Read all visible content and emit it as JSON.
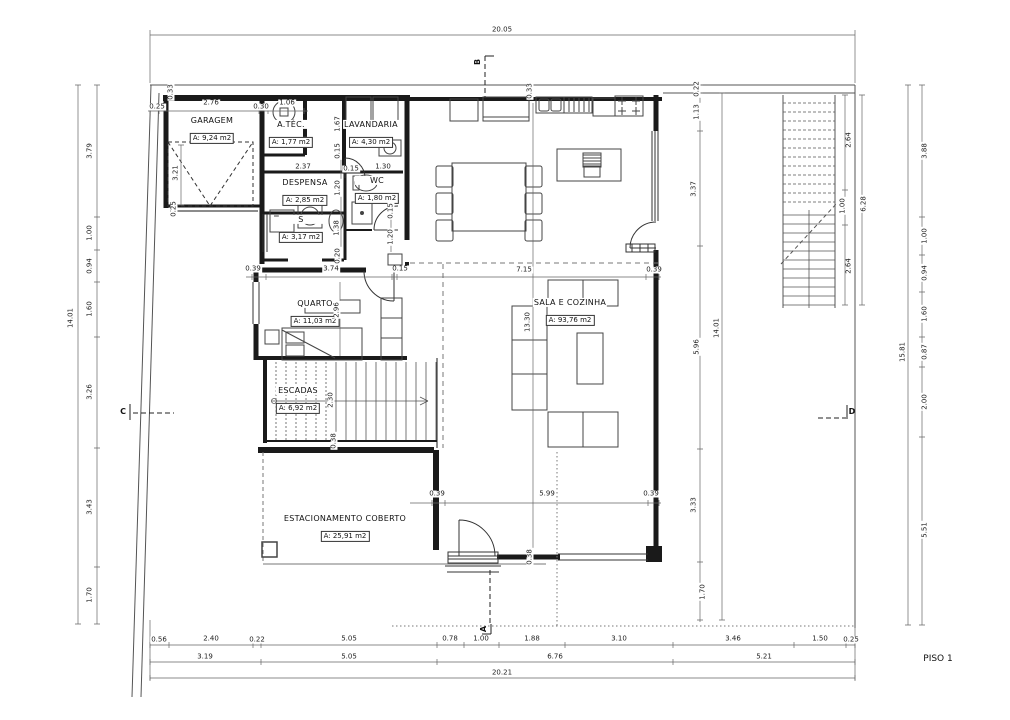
{
  "title": {
    "floor": "PISO 1"
  },
  "rooms": [
    {
      "name": "GARAGEM",
      "area": "A: 9,24 m2",
      "x": 212,
      "y": 130
    },
    {
      "name": "A.TÉC.",
      "area": "A: 1,77 m2",
      "x": 291,
      "y": 134
    },
    {
      "name": "LAVANDARIA",
      "area": "A: 4,30 m2",
      "x": 371,
      "y": 134
    },
    {
      "name": "DESPENSA",
      "area": "A: 2,85 m2",
      "x": 305,
      "y": 192
    },
    {
      "name": "WC",
      "area": "A: 1,80 m2",
      "x": 377,
      "y": 190
    },
    {
      "name": "S",
      "area": "A: 3,17 m2",
      "x": 301,
      "y": 229
    },
    {
      "name": "QUARTO",
      "area": "A: 11,03 m2",
      "x": 315,
      "y": 313
    },
    {
      "name": "ESCADAS",
      "area": "A: 6,92 m2",
      "x": 298,
      "y": 400
    },
    {
      "name": "SALA E COZINHA",
      "area": "A: 93,76 m2",
      "x": 570,
      "y": 312
    },
    {
      "name": "ESTACIONAMENTO COBERTO",
      "area": "A: 25,91 m2",
      "x": 345,
      "y": 528
    }
  ],
  "dimensions": [
    {
      "v": "20.05",
      "x": 502,
      "y": 30,
      "o": "h"
    },
    {
      "v": "0.25",
      "x": 157,
      "y": 107,
      "o": "h"
    },
    {
      "v": "2.76",
      "x": 211,
      "y": 103,
      "o": "h"
    },
    {
      "v": "0.30",
      "x": 261,
      "y": 107,
      "o": "h"
    },
    {
      "v": "1.06",
      "x": 287,
      "y": 103,
      "o": "h"
    },
    {
      "v": "0.33",
      "x": 171,
      "y": 92,
      "o": "v"
    },
    {
      "v": "0.33",
      "x": 530,
      "y": 91,
      "o": "v"
    },
    {
      "v": "3.21",
      "x": 176,
      "y": 173,
      "o": "v"
    },
    {
      "v": "0.25",
      "x": 174,
      "y": 209,
      "o": "v"
    },
    {
      "v": "14.01",
      "x": 71,
      "y": 318,
      "o": "v"
    },
    {
      "v": "3.79",
      "x": 90,
      "y": 151,
      "o": "v"
    },
    {
      "v": "1.00",
      "x": 90,
      "y": 233,
      "o": "v"
    },
    {
      "v": "0.94",
      "x": 90,
      "y": 266,
      "o": "v"
    },
    {
      "v": "1.60",
      "x": 90,
      "y": 309,
      "o": "v"
    },
    {
      "v": "3.26",
      "x": 90,
      "y": 392,
      "o": "v"
    },
    {
      "v": "3.43",
      "x": 90,
      "y": 507,
      "o": "v"
    },
    {
      "v": "1.70",
      "x": 90,
      "y": 595,
      "o": "v"
    },
    {
      "v": "1.67",
      "x": 338,
      "y": 124,
      "o": "v"
    },
    {
      "v": "2.37",
      "x": 303,
      "y": 167,
      "o": "h"
    },
    {
      "v": "0.15",
      "x": 351,
      "y": 169,
      "o": "h"
    },
    {
      "v": "1.30",
      "x": 383,
      "y": 167,
      "o": "h"
    },
    {
      "v": "0.15",
      "x": 338,
      "y": 151,
      "o": "v"
    },
    {
      "v": "1.20",
      "x": 338,
      "y": 188,
      "o": "v"
    },
    {
      "v": "1.38",
      "x": 337,
      "y": 228,
      "o": "v"
    },
    {
      "v": "0.20",
      "x": 338,
      "y": 256,
      "o": "v"
    },
    {
      "v": "0.15",
      "x": 391,
      "y": 211,
      "o": "v"
    },
    {
      "v": "1.20",
      "x": 391,
      "y": 237,
      "o": "v"
    },
    {
      "v": "0.39",
      "x": 253,
      "y": 269,
      "o": "h"
    },
    {
      "v": "3.74",
      "x": 331,
      "y": 269,
      "o": "h"
    },
    {
      "v": "0.15",
      "x": 400,
      "y": 269,
      "o": "h"
    },
    {
      "v": "7.15",
      "x": 524,
      "y": 270,
      "o": "h"
    },
    {
      "v": "0.39",
      "x": 654,
      "y": 270,
      "o": "h"
    },
    {
      "v": "2.96",
      "x": 337,
      "y": 310,
      "o": "v"
    },
    {
      "v": "13.30",
      "x": 528,
      "y": 322,
      "o": "v"
    },
    {
      "v": "2.30",
      "x": 331,
      "y": 400,
      "o": "v"
    },
    {
      "v": "0.38",
      "x": 334,
      "y": 441,
      "o": "v"
    },
    {
      "v": "0.39",
      "x": 437,
      "y": 494,
      "o": "h"
    },
    {
      "v": "5.99",
      "x": 547,
      "y": 494,
      "o": "h"
    },
    {
      "v": "0.39",
      "x": 651,
      "y": 494,
      "o": "h"
    },
    {
      "v": "0.38",
      "x": 530,
      "y": 557,
      "o": "v"
    },
    {
      "v": "0.22",
      "x": 697,
      "y": 89,
      "o": "v"
    },
    {
      "v": "1.13",
      "x": 697,
      "y": 112,
      "o": "v"
    },
    {
      "v": "3.37",
      "x": 694,
      "y": 189,
      "o": "v"
    },
    {
      "v": "5.96",
      "x": 697,
      "y": 347,
      "o": "v"
    },
    {
      "v": "3.33",
      "x": 694,
      "y": 505,
      "o": "v"
    },
    {
      "v": "1.70",
      "x": 703,
      "y": 592,
      "o": "v"
    },
    {
      "v": "14.01",
      "x": 717,
      "y": 328,
      "o": "v"
    },
    {
      "v": "2.64",
      "x": 849,
      "y": 140,
      "o": "v"
    },
    {
      "v": "1.00",
      "x": 843,
      "y": 206,
      "o": "v"
    },
    {
      "v": "6.28",
      "x": 864,
      "y": 204,
      "o": "v"
    },
    {
      "v": "2.64",
      "x": 849,
      "y": 266,
      "o": "v"
    },
    {
      "v": "15.81",
      "x": 903,
      "y": 352,
      "o": "v"
    },
    {
      "v": "3.88",
      "x": 925,
      "y": 151,
      "o": "v"
    },
    {
      "v": "1.00",
      "x": 925,
      "y": 236,
      "o": "v"
    },
    {
      "v": "0.94",
      "x": 925,
      "y": 273,
      "o": "v"
    },
    {
      "v": "1.60",
      "x": 925,
      "y": 314,
      "o": "v"
    },
    {
      "v": "0.87",
      "x": 925,
      "y": 352,
      "o": "v"
    },
    {
      "v": "2.00",
      "x": 925,
      "y": 402,
      "o": "v"
    },
    {
      "v": "5.51",
      "x": 925,
      "y": 530,
      "o": "v"
    },
    {
      "v": "0.56",
      "x": 159,
      "y": 640,
      "o": "h"
    },
    {
      "v": "2.40",
      "x": 211,
      "y": 639,
      "o": "h"
    },
    {
      "v": "0.22",
      "x": 257,
      "y": 640,
      "o": "h"
    },
    {
      "v": "5.05",
      "x": 349,
      "y": 639,
      "o": "h"
    },
    {
      "v": "0.78",
      "x": 450,
      "y": 639,
      "o": "h"
    },
    {
      "v": "1.00",
      "x": 481,
      "y": 639,
      "o": "h"
    },
    {
      "v": "1.88",
      "x": 532,
      "y": 639,
      "o": "h"
    },
    {
      "v": "3.10",
      "x": 619,
      "y": 639,
      "o": "h"
    },
    {
      "v": "3.46",
      "x": 733,
      "y": 639,
      "o": "h"
    },
    {
      "v": "1.50",
      "x": 820,
      "y": 639,
      "o": "h"
    },
    {
      "v": "0.25",
      "x": 851,
      "y": 640,
      "o": "h"
    },
    {
      "v": "3.19",
      "x": 205,
      "y": 657,
      "o": "h"
    },
    {
      "v": "5.05",
      "x": 349,
      "y": 657,
      "o": "h"
    },
    {
      "v": "6.76",
      "x": 555,
      "y": 657,
      "o": "h"
    },
    {
      "v": "5.21",
      "x": 764,
      "y": 657,
      "o": "h"
    },
    {
      "v": "20.21",
      "x": 502,
      "y": 673,
      "o": "h"
    }
  ],
  "sections": [
    {
      "label": "B",
      "x": 478,
      "y": 62,
      "rot": -90
    },
    {
      "label": "A",
      "x": 484,
      "y": 629,
      "rot": -90
    },
    {
      "label": "C",
      "x": 123,
      "y": 412,
      "rot": 0
    },
    {
      "label": "D",
      "x": 852,
      "y": 412,
      "rot": 0
    }
  ]
}
